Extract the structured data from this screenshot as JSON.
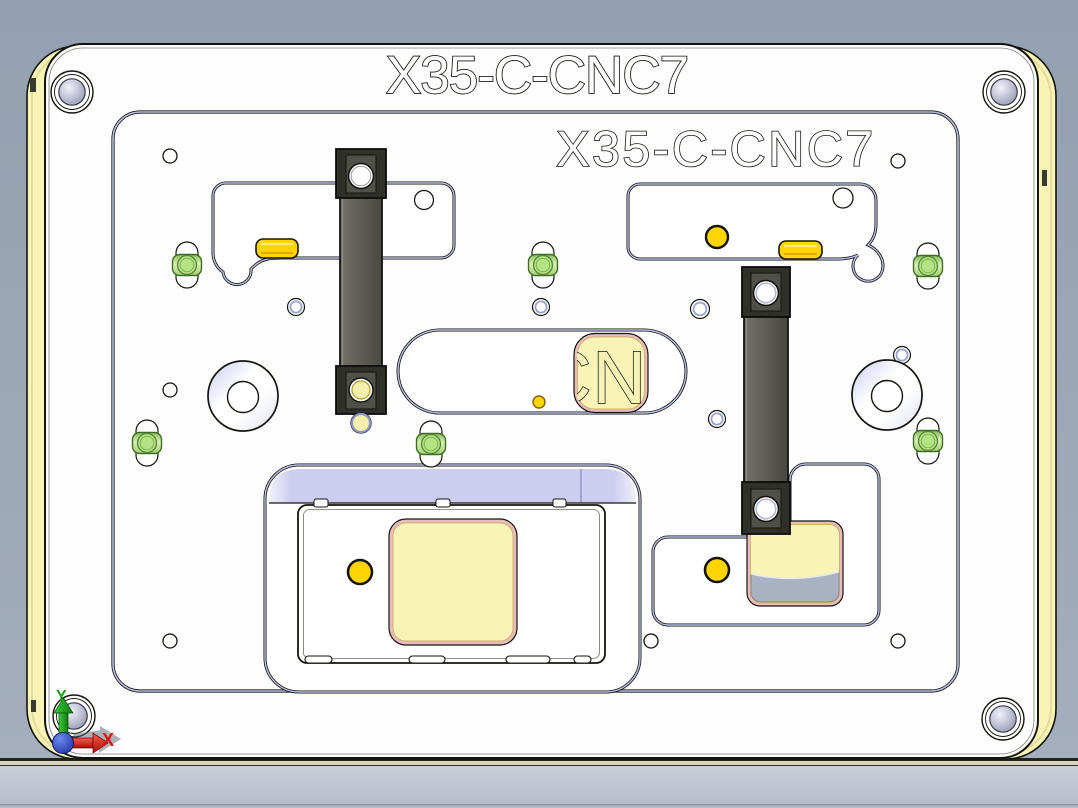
{
  "titles": {
    "engraved_top": "X35-C-CNC7",
    "engraved_plate": "X35-C-CNC7",
    "pad_engraving_visible": "CNC"
  },
  "axis_triad": {
    "x_label": "X",
    "y_label": "Y",
    "x_color": "#d81510",
    "y_color": "#14a014",
    "origin_color": "#2a46c8"
  },
  "colors": {
    "viewport_background": "#9aa5b5",
    "table_front_gray": "#c6cad5",
    "table_edge_khaki": "#d9d5bb",
    "base_plate_yellow": "#f8f4b6",
    "top_plate_white": "#fdfdfd",
    "pocket_edge_lavender": "#b9bfe2",
    "recess_wall_lavender": "#cdcdf0",
    "clamp_block_dark": "#30302a",
    "clamp_bar_gray": "#5d5d55",
    "support_green": "#b5e282",
    "button_yellow": "#fed500",
    "pad_cream": "#f8f4b8",
    "pad_border_pink": "#e8bcbc",
    "pad_gray_step": "#a9b1c3",
    "outline_black": "#14140f"
  }
}
